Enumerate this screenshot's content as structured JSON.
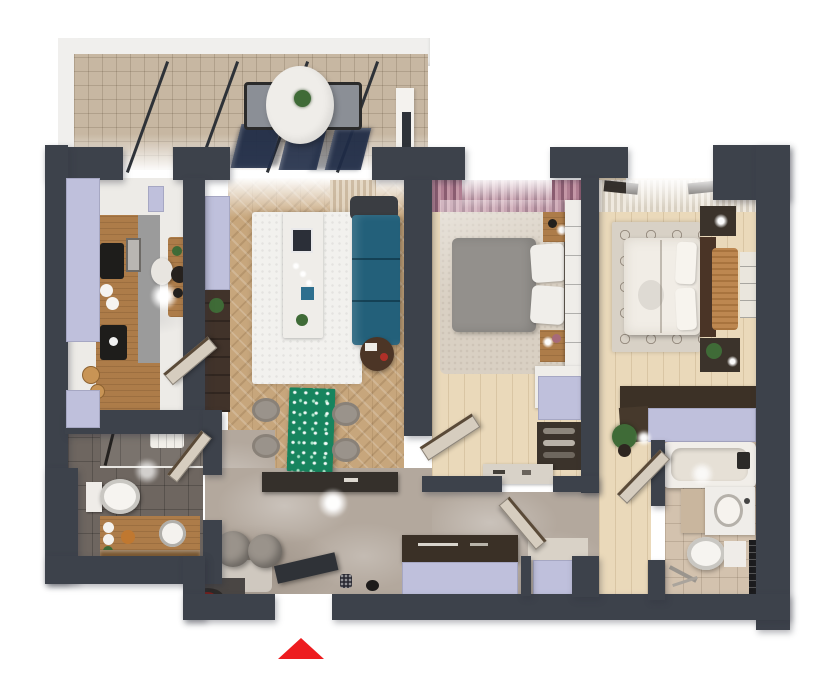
{
  "meta": {
    "description": "Photorealistic 3D rendered top-down floor plan of a two-bedroom apartment with balcony, no text labels",
    "canvas_width": 836,
    "canvas_height": 699,
    "background": "#ffffff"
  },
  "colors": {
    "wall": "#3d424b",
    "lavender": "#bfc0dc",
    "balcony_tile": "#c7b7a2",
    "railing_white": "#f0efed",
    "glass_navy": "#1f2c47",
    "marble_floor": "#edebe7",
    "herringbone_floor": "#c7a67c",
    "carpet_floor": "#d9d0c3",
    "wood_floor": "#ead9ba",
    "hall_floor": "#b3a89d",
    "bath_dark_tile": "#6e6660",
    "bath_beige_tile": "#d3c2ae",
    "rug_white": "#f2f1ee",
    "rug_trellis": "#d8d1c6",
    "sofa_teal": "#23607a",
    "table_green": "#17845e",
    "bed_gray": "#93908c",
    "bed_white": "#f1ede6",
    "wood_furniture": "#ad7c49",
    "dark_furniture": "#3b332b",
    "white_furniture": "#efede9",
    "curtain_mauve": "#a9758a",
    "curtain_cream": "#dbcbb6",
    "plant_green": "#3f6b37",
    "red_cup": "#b03028",
    "arrow_red": "#ed1c1f",
    "door_leaf": "#d6cdbf",
    "entry_door_dark": "#2f3237",
    "pouf_gray": "#9a938b",
    "orange_throw": "#bd8750",
    "counter_gray": "#9b9b9b",
    "cooktop_black": "#1e1d1b",
    "headboard_brown": "#4a3426"
  },
  "rooms": [
    {
      "id": "balcony",
      "furniture": [
        "round-outdoor-table",
        "potted-plant",
        "outdoor-chair-left",
        "outdoor-chair-right",
        "glass-railing-panels",
        "white-railing"
      ]
    },
    {
      "id": "kitchen",
      "furniture": [
        "counter-with-cooktop",
        "oven",
        "coffee-machine",
        "sink-boards",
        "dining-table",
        "white-chair",
        "pendant-lamp",
        "window-sills"
      ]
    },
    {
      "id": "living-room",
      "furniture": [
        "teal-sofa",
        "white-coffee-table",
        "white-rug",
        "green-dining-table",
        "four-round-chairs",
        "side-table-with-red-cup",
        "tv-column",
        "lavender-cabinet",
        "console"
      ]
    },
    {
      "id": "bedroom-1",
      "furniture": [
        "gray-double-bed",
        "white-pillows",
        "nightstands",
        "drawer-dresser",
        "wardrobe",
        "shoe-rack",
        "sideboard",
        "mauve-curtains"
      ]
    },
    {
      "id": "bedroom-2",
      "furniture": [
        "white-double-bed",
        "dark-headboard",
        "orange-throw-bench",
        "nightstands",
        "book-shelf",
        "trellis-rug",
        "wardrobe-lavender-front",
        "white-curtains",
        "potted-plant"
      ]
    },
    {
      "id": "bathroom-1",
      "furniture": [
        "shower",
        "towels",
        "toilet",
        "wood-vanity",
        "round-sink",
        "mirror"
      ]
    },
    {
      "id": "bathroom-2",
      "furniture": [
        "bathtub",
        "vanity-sink",
        "toilet",
        "towel-radiator",
        "shower-set"
      ]
    },
    {
      "id": "hallway",
      "furniture": [
        "two-round-poufs",
        "closets-lavender-front",
        "entry-console",
        "doormat",
        "ceiling-lamp"
      ]
    }
  ],
  "entrance": {
    "marker": "red-arrow",
    "direction": "up",
    "position": "bottom-center"
  }
}
